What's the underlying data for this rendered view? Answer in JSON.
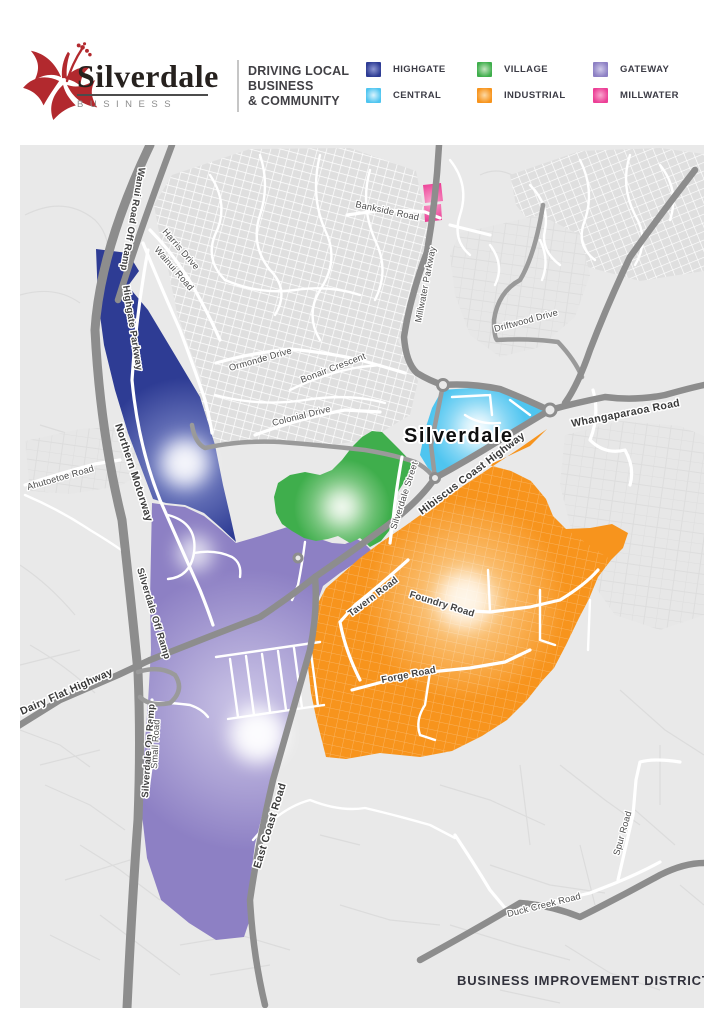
{
  "header": {
    "logo": {
      "brand": "Silverdale",
      "sub": "BUSINESS"
    },
    "tagline_lines": [
      "DRIVING LOCAL",
      "BUSINESS",
      "& COMMUNITY"
    ],
    "legend": [
      {
        "id": "highgate",
        "label": "HIGHGATE",
        "color": "#2e3c94",
        "center": "#8d97d2"
      },
      {
        "id": "central",
        "label": "CENTRAL",
        "color": "#4fc5f0",
        "center": "#daf3fd"
      },
      {
        "id": "village",
        "label": "VILLAGE",
        "color": "#3fae4c",
        "center": "#c4e5c0"
      },
      {
        "id": "industrial",
        "label": "INDUSTRIAL",
        "color": "#f7941d",
        "center": "#fcd9a4"
      },
      {
        "id": "gateway",
        "label": "GATEWAY",
        "color": "#8d80c4",
        "center": "#cfc9e9"
      },
      {
        "id": "millwater",
        "label": "MILLWATER",
        "color": "#ec3f96",
        "center": "#f9a8cf"
      }
    ]
  },
  "map": {
    "place_label": "Silverdale",
    "caption": "BUSINESS IMPROVEMENT DISTRICT",
    "roads": {
      "wanui_road_off_ramp": "Wanui Road Off Ramp",
      "harris_drive": "Harris Drive",
      "wainui_road": "Wainui Road",
      "highgate_parkway": "Highgate Parkway",
      "northern_motorway": "Northern Motorway",
      "ormonde_drive": "Ormonde Drive",
      "bonair_crescent": "Bonair Crescent",
      "colonial_drive": "Colonial Drive",
      "bankside_road": "Bankside Road",
      "millwater_parkway": "Millwater Parkway",
      "driftwood_drive": "Driftwood Drive",
      "whangaparaoa_road": "Whangaparaoa Road",
      "silverdale_street": "Silverdale Street",
      "hibiscus_coast_highway": "Hibiscus Coast Highway",
      "ahutoetoe_road": "Ahutoetoe Road",
      "silverdale_off_ramp": "Silverdale Off Ramp",
      "dairy_flat_highway": "Dairy Flat Highway",
      "silverdale_on_ramp": "Silverdale On Ramp",
      "small_road": "Small Road",
      "east_coast_road": "East Coast Road",
      "tavern_road": "Tavern Road",
      "foundry_road": "Foundry Road",
      "forge_road": "Forge Road",
      "duck_creek_road": "Duck Creek Road",
      "spur_road": "Spur Road"
    }
  }
}
